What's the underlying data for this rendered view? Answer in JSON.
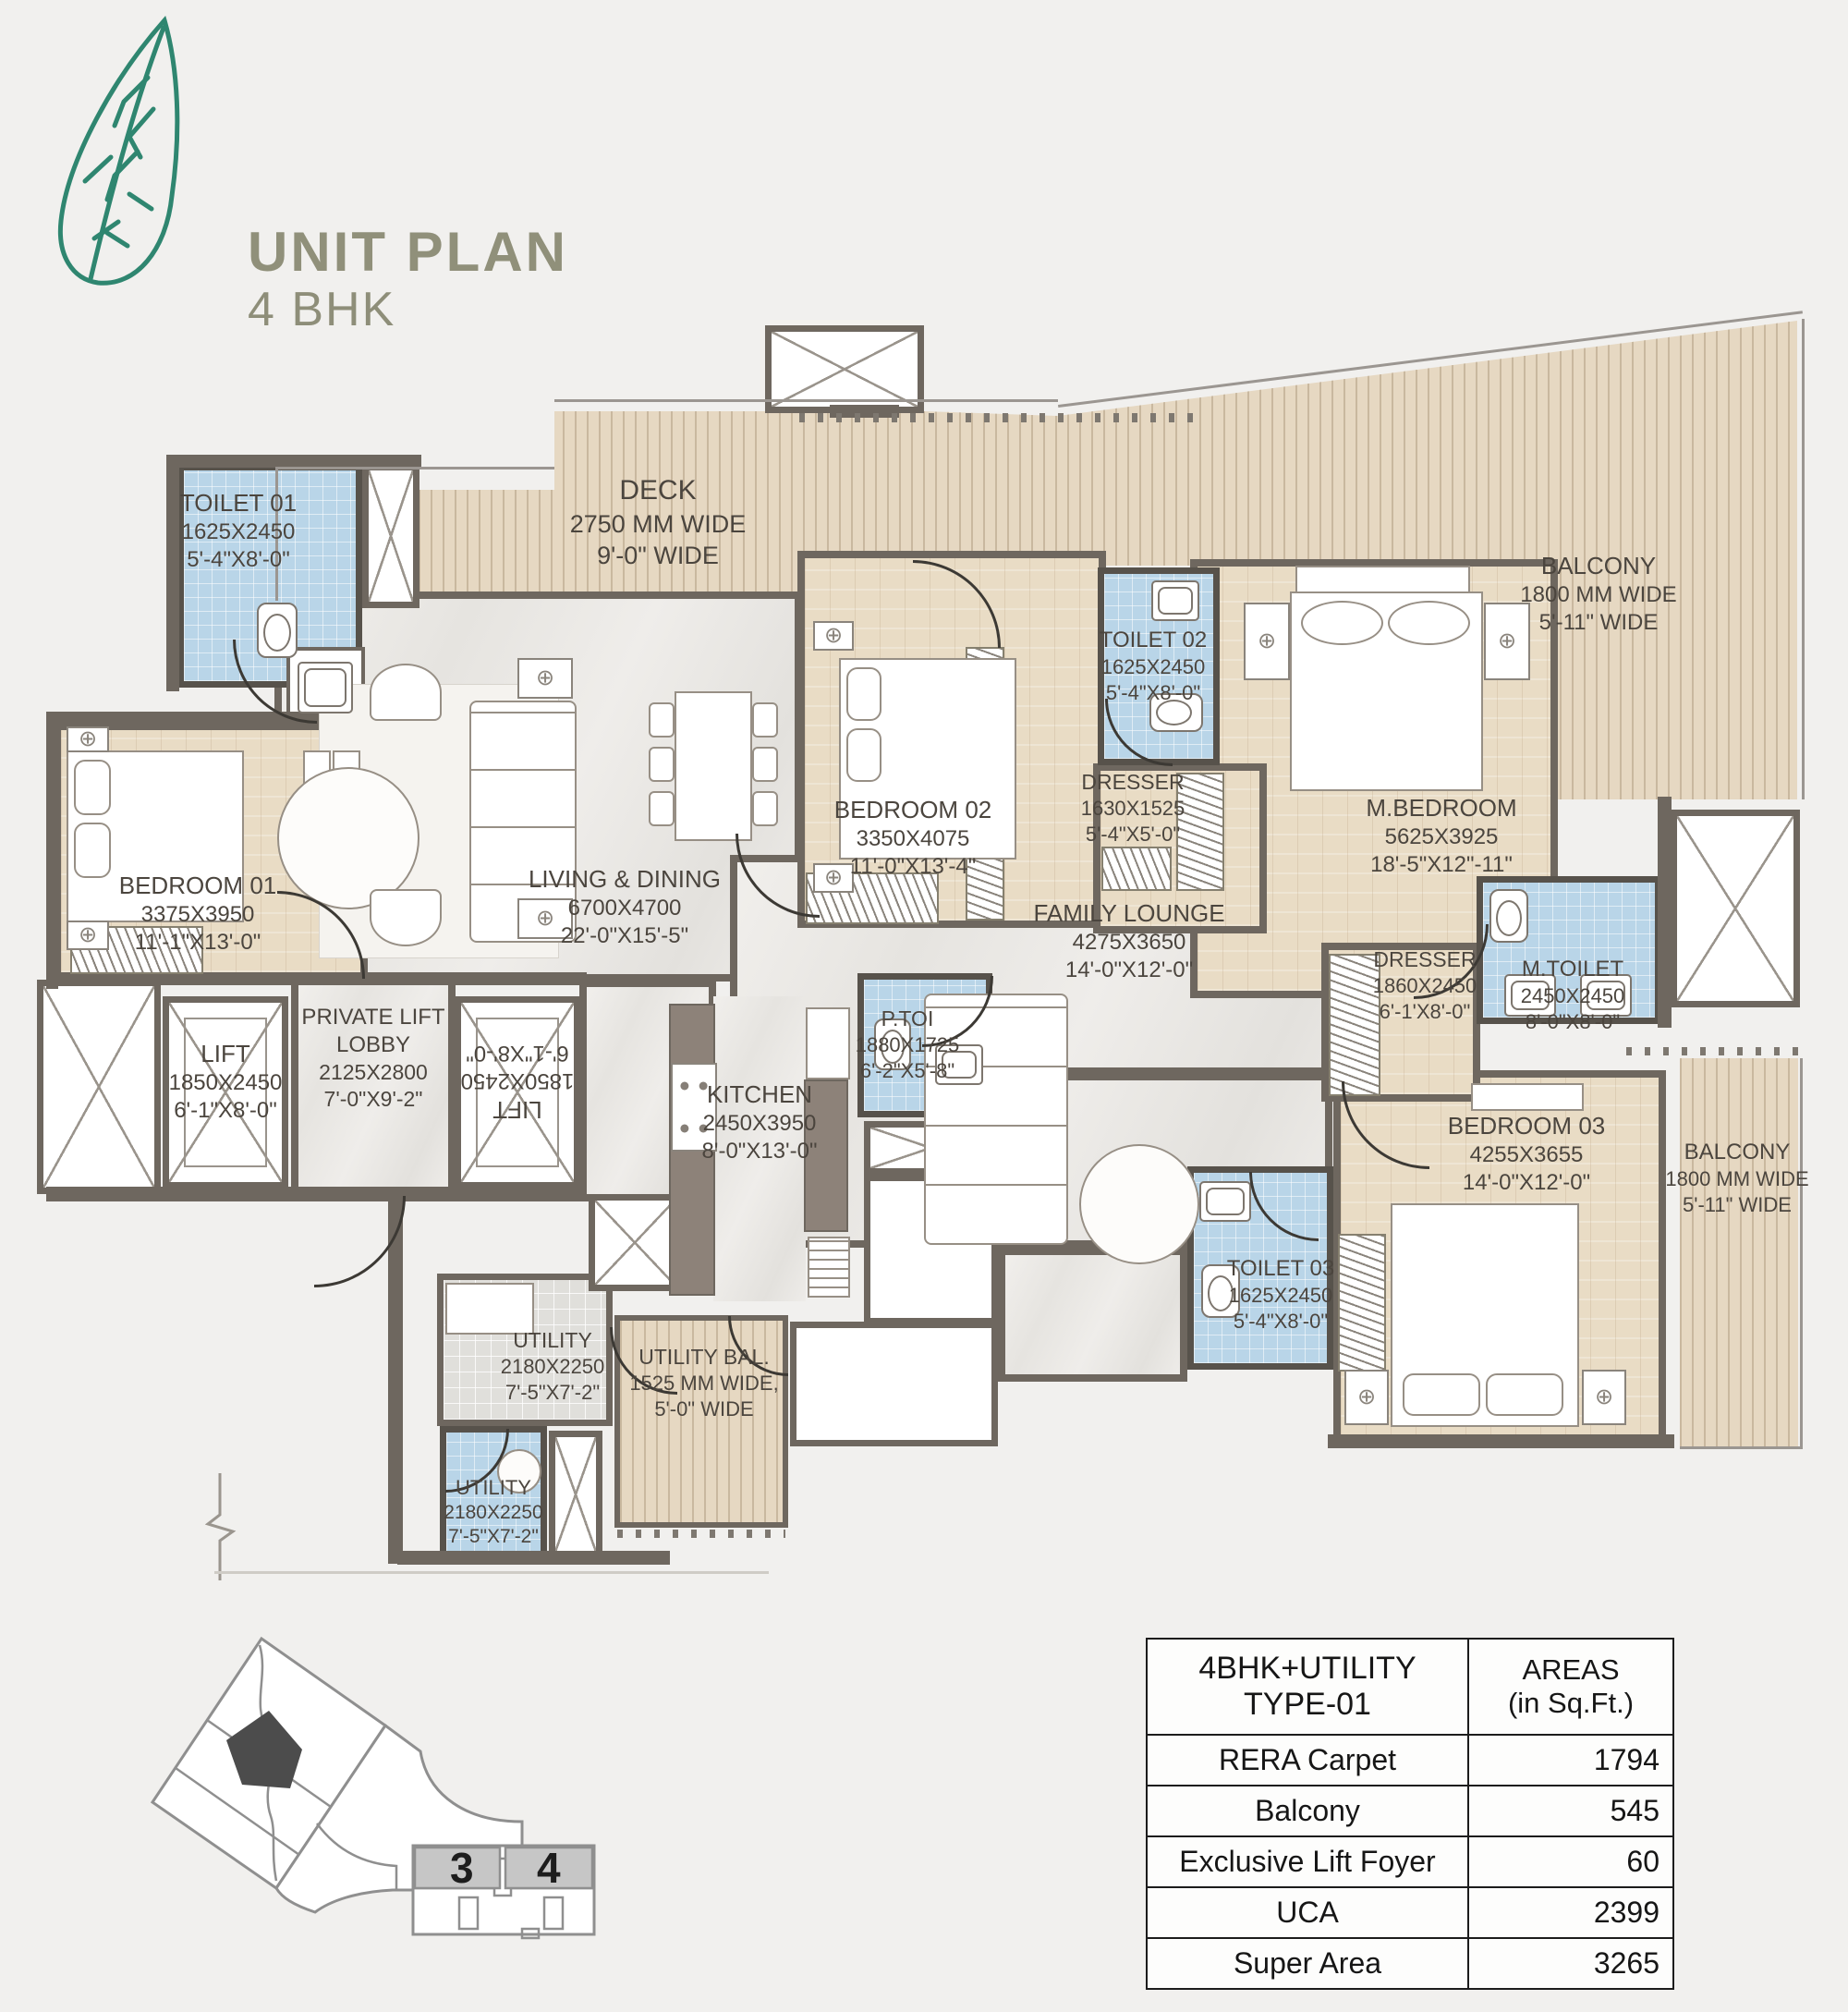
{
  "title": {
    "main": "UNIT PLAN",
    "sub": "4 BHK"
  },
  "logo": "leaf-icon",
  "colors": {
    "background": "#f1f0ee",
    "wall": "#6e675f",
    "wood_floor": "#e9dcc5",
    "deck_plank": "#e6d8c2",
    "toilet_tile": "#b9d5e8",
    "marble": "#eceae6",
    "title_olive": "#90907a",
    "leaf_green": "#2f8670",
    "keyplan_unit_fill": "#4c4c4c",
    "keyplan_cell_fill": "#c6c6c6"
  },
  "rooms": {
    "toilet01": {
      "name": "TOILET 01",
      "mm": "1625X2450",
      "ft": "5'-4\"X8'-0\""
    },
    "deck": {
      "name": "DECK",
      "mm": "2750 MM WIDE",
      "ft": "9'-0\" WIDE"
    },
    "balconyTop": {
      "name": "BALCONY",
      "mm": "1800 MM WIDE",
      "ft": "5'-11\" WIDE"
    },
    "bedroom01": {
      "name": "BEDROOM 01",
      "mm": "3375X3950",
      "ft": "11'-1\"X13'-0\""
    },
    "living": {
      "name": "LIVING & DINING",
      "mm": "6700X4700",
      "ft": "22'-0\"X15'-5\""
    },
    "bedroom02": {
      "name": "BEDROOM 02",
      "mm": "3350X4075",
      "ft": "11'-0\"X13'-4\""
    },
    "toilet02": {
      "name": "TOILET 02",
      "mm": "1625X2450",
      "ft": "5'-4\"X8'-0\""
    },
    "dresser02": {
      "name": "DRESSER",
      "mm": "1630X1525",
      "ft": "5'-4\"X5'-0\""
    },
    "mbedroom": {
      "name": "M.BEDROOM",
      "mm": "5625X3925",
      "ft": "18'-5\"X12\"-11\""
    },
    "family": {
      "name": "FAMILY LOUNGE",
      "mm": "4275X3650",
      "ft": "14'-0\"X12'-0\""
    },
    "mdresser": {
      "name": "DRESSER",
      "mm": "1860X2450",
      "ft": "6'-1'X8'-0\""
    },
    "mtoilet": {
      "name": "M.TOILET",
      "mm": "2450X2450",
      "ft": "8'-0\"X8'-0\""
    },
    "ptoi": {
      "name": "P.TOI",
      "mm": "1880X1725",
      "ft": "6'-2\"X5'-8\""
    },
    "lift1": {
      "name": "LIFT",
      "mm": "1850X2450",
      "ft": "6'-1\"X8'-0\""
    },
    "lobby": {
      "name": "PRIVATE LIFT",
      "name2": "LOBBY",
      "mm": "2125X2800",
      "ft": "7'-0\"X9'-2\""
    },
    "lift2": {
      "name": "LIFT",
      "mm": "1850X2450",
      "ft": "6'-1\"X8'-0\""
    },
    "kitchen": {
      "name": "KITCHEN",
      "mm": "2450X3950",
      "ft": "8'-0\"X13'-0\""
    },
    "bedroom03": {
      "name": "BEDROOM 03",
      "mm": "4255X3655",
      "ft": "14'-0\"X12'-0\""
    },
    "toilet03": {
      "name": "TOILET 03",
      "mm": "1625X2450",
      "ft": "5'-4\"X8'-0\""
    },
    "balconyRight": {
      "name": "BALCONY",
      "mm": "1800 MM WIDE",
      "ft": "5'-11\" WIDE"
    },
    "utility1": {
      "name": "UTILITY",
      "mm": "2180X2250",
      "ft": "7'-5\"X7'-2\""
    },
    "utility2": {
      "name": "UTILITY",
      "mm": "2180X2250",
      "ft": "7'-5\"X7'-2\""
    },
    "utilitybal": {
      "name": "UTILITY BAL.",
      "mm": "1525 MM WIDE,",
      "ft": "5'-0\" WIDE"
    }
  },
  "areas_table": {
    "col1_header": "4BHK+UTILITY TYPE-01",
    "col2_header_line1": "AREAS",
    "col2_header_line2": "(in Sq.Ft.)",
    "rows": [
      {
        "label": "RERA Carpet",
        "value": "1794"
      },
      {
        "label": "Balcony",
        "value": "545"
      },
      {
        "label": "Exclusive Lift Foyer",
        "value": "60"
      },
      {
        "label": "UCA",
        "value": "2399"
      },
      {
        "label": "Super Area",
        "value": "3265"
      }
    ]
  },
  "key_plan": {
    "unit3": "3",
    "unit4": "4"
  }
}
